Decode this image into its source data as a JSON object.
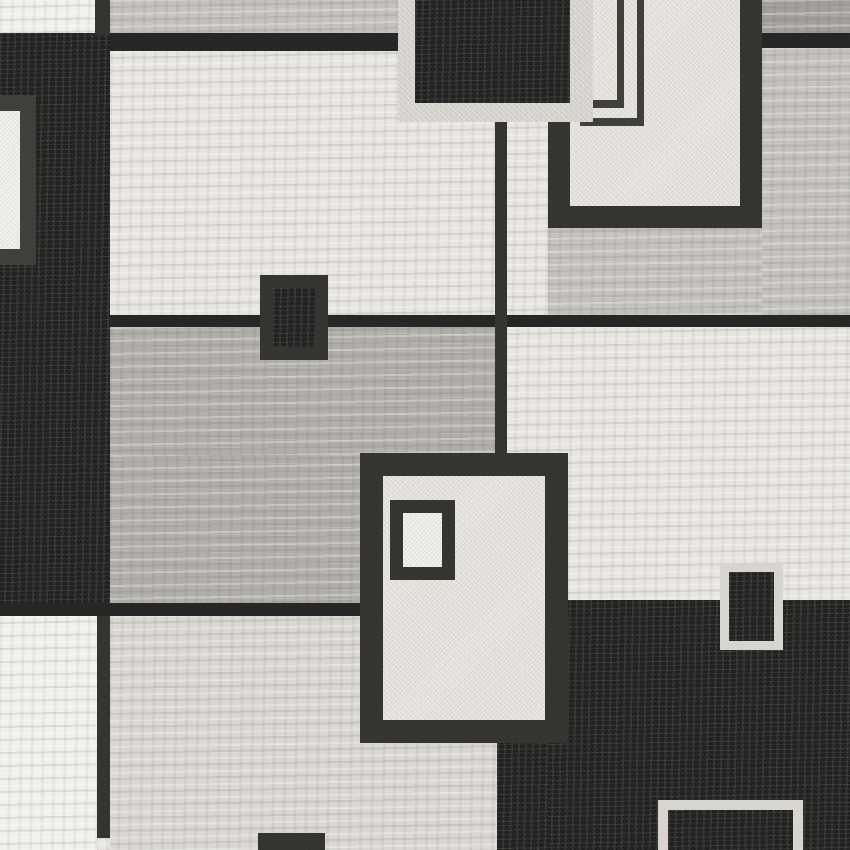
{
  "canvas": {
    "width": 850,
    "height": 850
  },
  "palette": {
    "cream": "#e7e4de",
    "cream_bright": "#f1efe9",
    "panel_light": "#d8d5cf",
    "gray_light": "#c1beb8",
    "gray_mid": "#adaaa4",
    "gray_dark": "#9e9b96",
    "black": "#181817",
    "black_soft": "#202020",
    "charcoal": "#2e2d2a",
    "charcoal_light": "#3a3834",
    "border_light": "#d5d2cb",
    "frame_fill": "#e5e2db",
    "inner_fill": "#f0eee8"
  },
  "regions": [
    {
      "name": "base-weave",
      "x": 0,
      "y": 0,
      "w": 850,
      "h": 850,
      "fill": "cream",
      "texture": "streak"
    },
    {
      "name": "left-black-column",
      "x": 0,
      "y": 33,
      "w": 110,
      "h": 574,
      "fill": "black",
      "texture": "black"
    },
    {
      "name": "left-edge-framed-square",
      "x": -32,
      "y": 95,
      "w": 68,
      "h": 170,
      "fill": "cream_bright",
      "texture": "speckle",
      "border": {
        "width": 16,
        "color": "charcoal_light"
      }
    },
    {
      "name": "top-left-white-corner",
      "x": 0,
      "y": 0,
      "w": 95,
      "h": 33,
      "fill": "cream_bright",
      "texture": "streak"
    },
    {
      "name": "top-left-corner-divider",
      "x": 95,
      "y": 0,
      "w": 15,
      "h": 35,
      "fill": "charcoal"
    },
    {
      "name": "top-gray-strip",
      "x": 110,
      "y": 0,
      "w": 288,
      "h": 33,
      "fill": "gray_light",
      "texture": "streak"
    },
    {
      "name": "top-gray-strip-underline",
      "x": 110,
      "y": 33,
      "w": 288,
      "h": 18,
      "fill": "black_soft"
    },
    {
      "name": "upper-left-cream-panel",
      "x": 110,
      "y": 51,
      "w": 395,
      "h": 264,
      "fill": "cream",
      "texture": "streak"
    },
    {
      "name": "top-right-gray-corner",
      "x": 762,
      "y": 0,
      "w": 88,
      "h": 33,
      "fill": "gray_dark",
      "texture": "streak"
    },
    {
      "name": "top-right-corner-underline",
      "x": 762,
      "y": 33,
      "w": 88,
      "h": 15,
      "fill": "black_soft"
    },
    {
      "name": "right-light-gray-panel",
      "x": 762,
      "y": 48,
      "w": 88,
      "h": 267,
      "fill": "gray_light",
      "texture": "streak"
    },
    {
      "name": "gray-below-bordered-panel",
      "x": 548,
      "y": 225,
      "w": 214,
      "h": 90,
      "fill": "gray_light",
      "texture": "streak"
    },
    {
      "name": "upper-cross-band",
      "x": 110,
      "y": 315,
      "w": 740,
      "h": 12,
      "fill": "black_soft"
    },
    {
      "name": "middle-gray-panel",
      "x": 110,
      "y": 327,
      "w": 395,
      "h": 128,
      "fill": "gray_mid",
      "texture": "streak"
    },
    {
      "name": "middle-gray-panel-lower",
      "x": 110,
      "y": 455,
      "w": 250,
      "h": 150,
      "fill": "gray_mid",
      "texture": "streak"
    },
    {
      "name": "right-cream-band",
      "x": 505,
      "y": 327,
      "w": 345,
      "h": 276,
      "fill": "cream",
      "texture": "streak"
    },
    {
      "name": "center-vertical-line",
      "x": 495,
      "y": 122,
      "w": 12,
      "h": 333,
      "fill": "charcoal"
    },
    {
      "name": "lower-cross-band",
      "x": 0,
      "y": 603,
      "w": 400,
      "h": 13,
      "fill": "black_soft"
    },
    {
      "name": "bottom-left-cream-block",
      "x": 0,
      "y": 616,
      "w": 97,
      "h": 234,
      "fill": "cream_bright",
      "texture": "streak"
    },
    {
      "name": "bottom-left-vertical-line",
      "x": 97,
      "y": 616,
      "w": 13,
      "h": 222,
      "fill": "charcoal"
    },
    {
      "name": "bottom-center-panel",
      "x": 110,
      "y": 616,
      "w": 395,
      "h": 234,
      "fill": "panel_light",
      "texture": "streak"
    },
    {
      "name": "bottom-right-black-field",
      "x": 548,
      "y": 600,
      "w": 302,
      "h": 250,
      "fill": "black",
      "texture": "black"
    },
    {
      "name": "bottom-right-black-extension",
      "x": 497,
      "y": 740,
      "w": 51,
      "h": 110,
      "fill": "black",
      "texture": "black"
    },
    {
      "name": "top-bordered-cream-panel",
      "x": 548,
      "y": -30,
      "w": 214,
      "h": 258,
      "fill": "frame_fill",
      "texture": "speckle",
      "border": {
        "width": 22,
        "color": "charcoal"
      }
    },
    {
      "name": "pinstripe-vertical-1",
      "x": 617,
      "y": 0,
      "w": 7,
      "h": 108,
      "fill": "charcoal_light"
    },
    {
      "name": "pinstripe-corner-1",
      "x": 580,
      "y": 100,
      "w": 44,
      "h": 8,
      "fill": "charcoal_light"
    },
    {
      "name": "pinstripe-vertical-2",
      "x": 637,
      "y": 0,
      "w": 7,
      "h": 126,
      "fill": "charcoal_light"
    },
    {
      "name": "pinstripe-corner-2",
      "x": 580,
      "y": 118,
      "w": 64,
      "h": 8,
      "fill": "charcoal_light"
    },
    {
      "name": "top-black-rect-light-border",
      "x": 398,
      "y": 0,
      "w": 195,
      "h": 122,
      "fill": "border_light",
      "texture": "speckle"
    },
    {
      "name": "top-black-rect",
      "x": 415,
      "y": 0,
      "w": 155,
      "h": 103,
      "fill": "black",
      "texture": "black"
    },
    {
      "name": "center-framed-panel",
      "x": 360,
      "y": 453,
      "w": 208,
      "h": 290,
      "fill": "frame_fill",
      "texture": "speckle",
      "border": {
        "width": 23,
        "color": "charcoal"
      }
    },
    {
      "name": "center-inner-square",
      "x": 390,
      "y": 500,
      "w": 65,
      "h": 80,
      "fill": "inner_fill",
      "texture": "speckle",
      "border": {
        "width": 13,
        "color": "charcoal"
      }
    },
    {
      "name": "mid-small-black-rect",
      "x": 260,
      "y": 275,
      "w": 68,
      "h": 85,
      "fill": "black",
      "texture": "black",
      "border": {
        "width": 13,
        "color": "charcoal"
      }
    },
    {
      "name": "right-small-framed-rect",
      "x": 720,
      "y": 563,
      "w": 63,
      "h": 87,
      "fill": "black",
      "texture": "black",
      "border": {
        "width": 9,
        "color": "border_light"
      }
    },
    {
      "name": "bottom-framed-rect",
      "x": 658,
      "y": 800,
      "w": 145,
      "h": 60,
      "fill": "black",
      "texture": "black",
      "border": {
        "width": 10,
        "color": "border_light"
      }
    },
    {
      "name": "bottom-edge-dark-piece",
      "x": 258,
      "y": 833,
      "w": 67,
      "h": 17,
      "fill": "charcoal"
    }
  ]
}
